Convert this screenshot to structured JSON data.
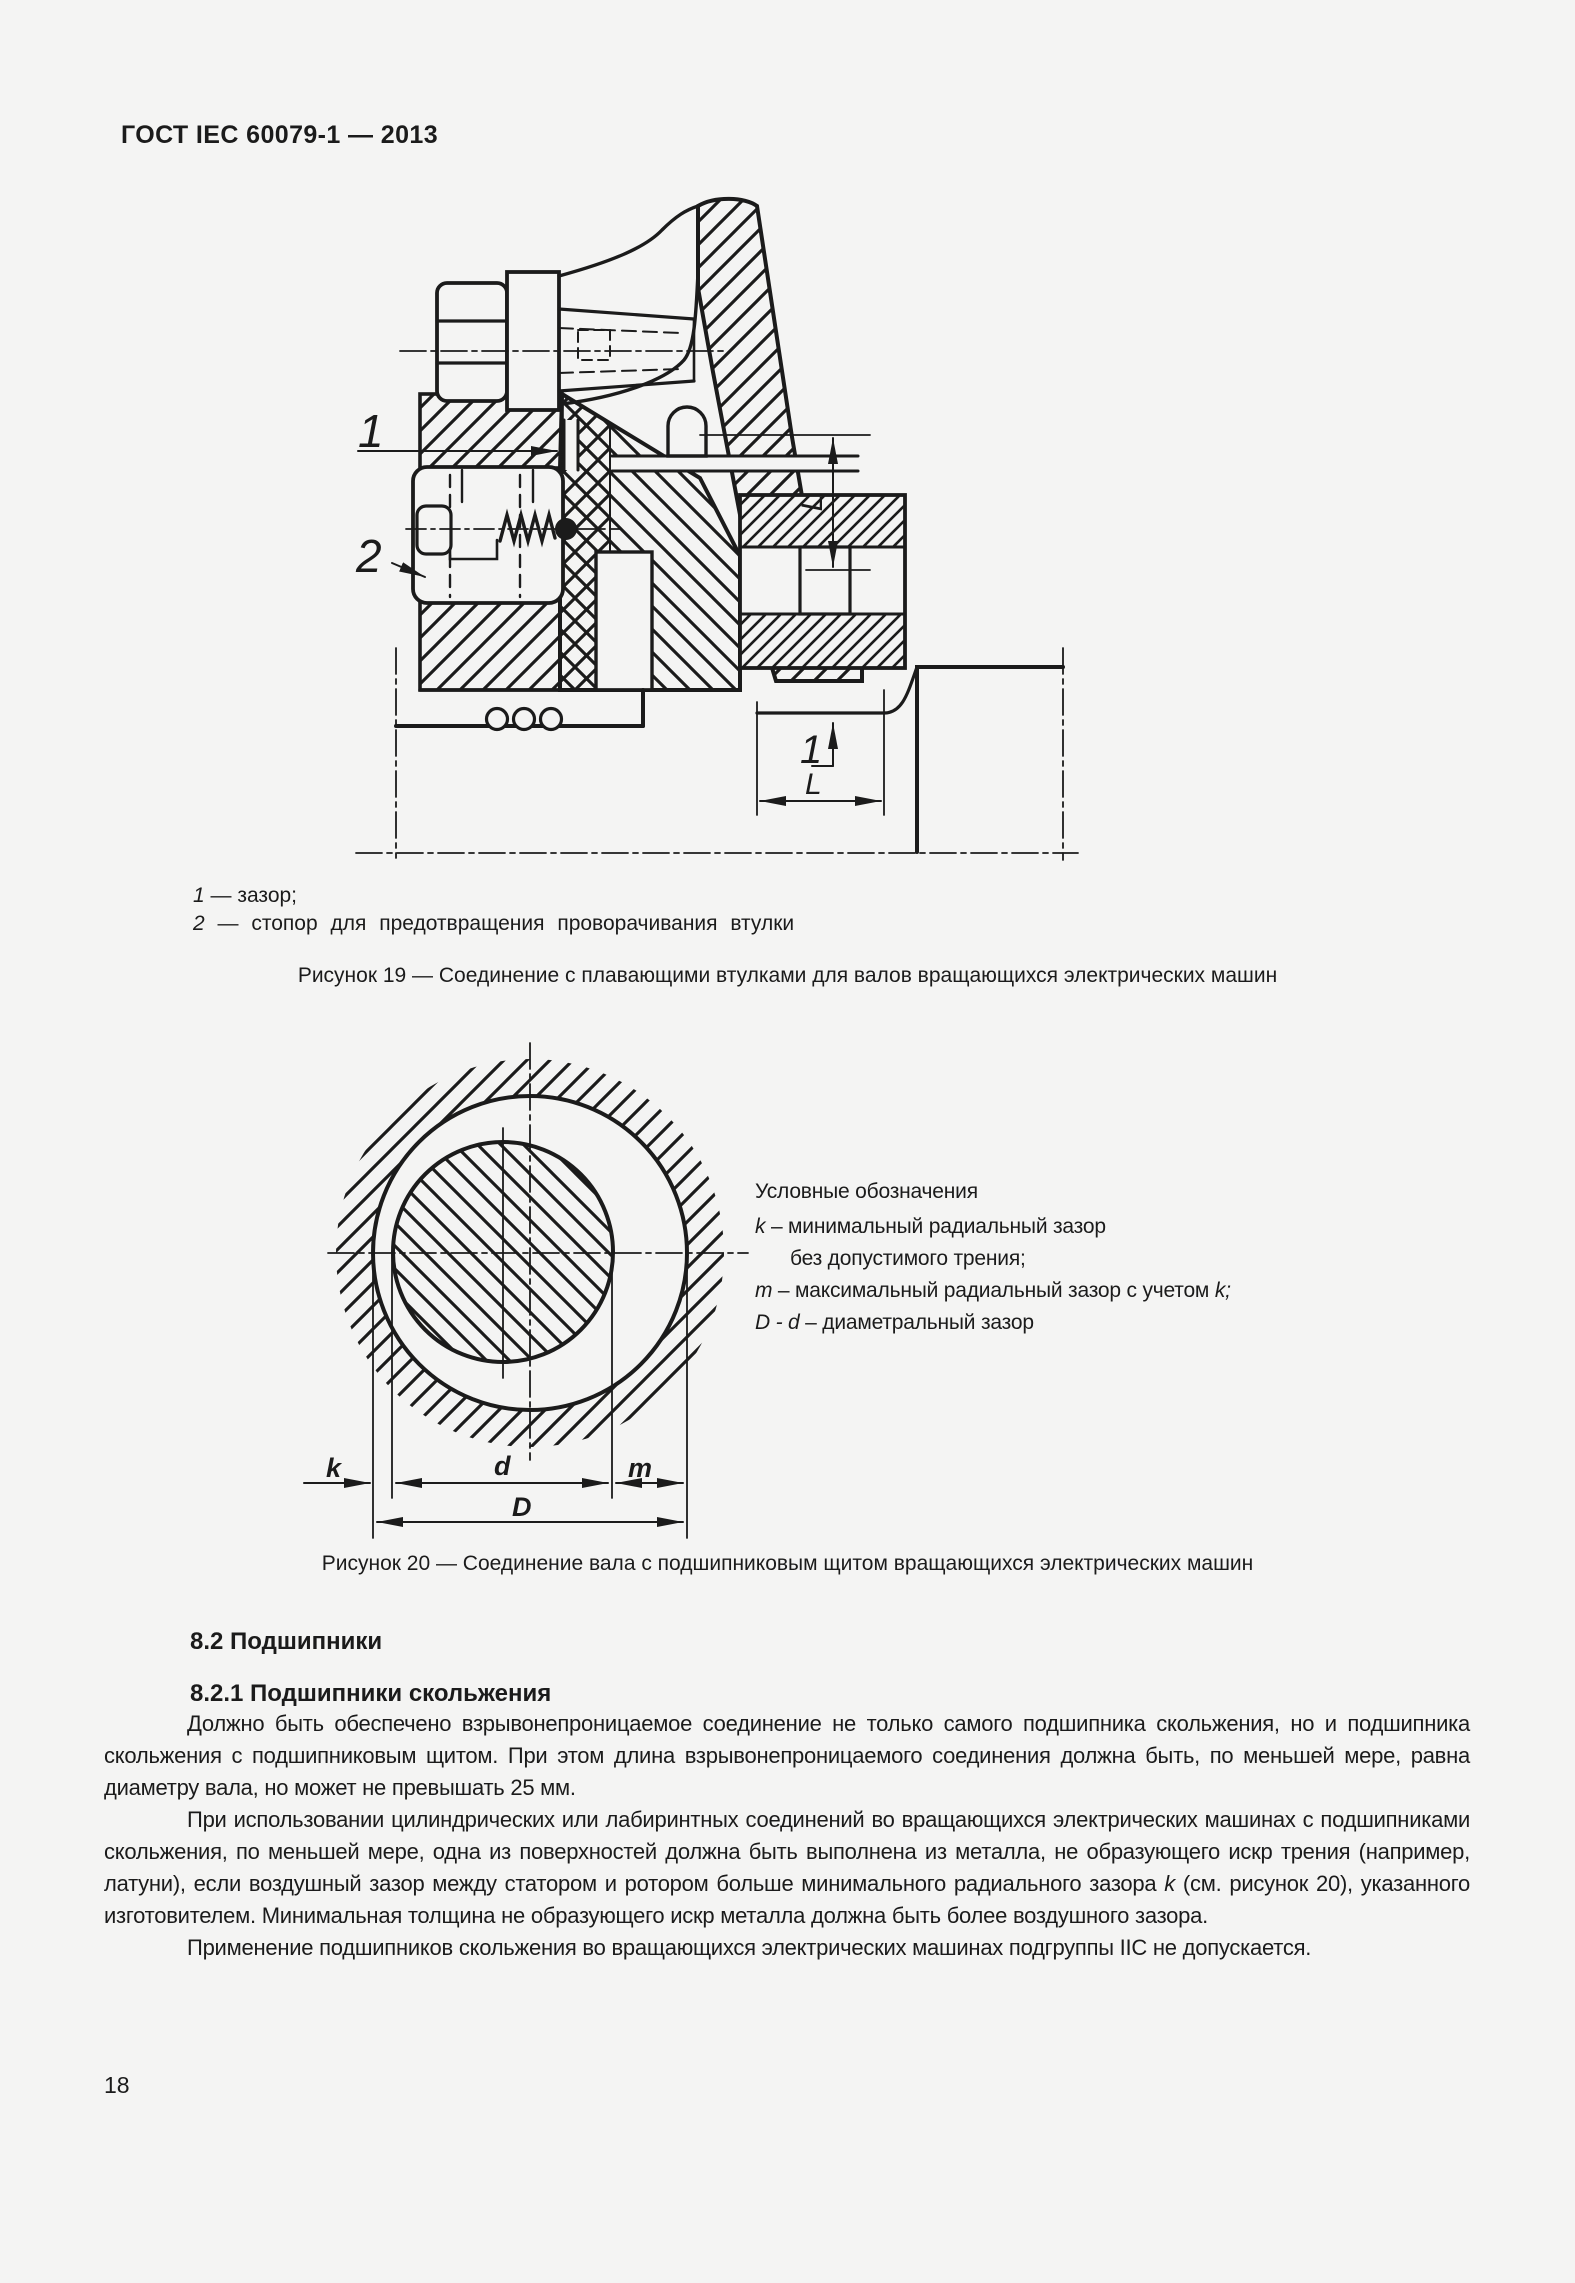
{
  "header": {
    "title": "ГОСТ IEC 60079-1 — 2013"
  },
  "figure19": {
    "labels": {
      "pointer1": "1",
      "pointer2": "2",
      "dim_l_vertical": "L",
      "dim_l_bottom": "L",
      "pointer1_bottom": "1"
    },
    "legend": {
      "item1_num": "1",
      "item1_text": " — зазор;",
      "item2_num": "2",
      "item2_text": " — стопор для предотвращения проворачивания втулки"
    },
    "caption": "Рисунок 19 — Соединение с плавающими втулками для валов вращающихся электрических машин"
  },
  "figure20": {
    "labels": {
      "k": "k",
      "d": "d",
      "m": "m",
      "D": "D"
    },
    "legend": {
      "title": "Условные обозначения",
      "k_sym": "k",
      "k_text": " – минимальный радиальный зазор",
      "k_text2": "без допустимого трения;",
      "m_sym": "m",
      "m_text": " – максимальный  радиальный зазор с учетом ",
      "m_k": "k;",
      "dd_sym": "D - d",
      "dd_text": " – диаметральный зазор"
    },
    "caption": "Рисунок 20 — Соединение вала с подшипниковым щитом вращающихся электрических машин"
  },
  "sections": {
    "h82": "8.2 Подшипники",
    "h821": "8.2.1 Подшипники скольжения"
  },
  "body": {
    "p1": "Должно быть обеспечено взрывонепроницаемое соединение не только самого подшипника скольжения, но и подшипника скольжения с подшипниковым щитом. При этом длина взрывонепроницаемого соединения должна быть, по меньшей мере, равна диаметру вала, но может не превышать 25 мм.",
    "p2a": "При использовании цилиндрических или лабиринтных соединений во вращающихся электрических машинах с подшипниками скольжения, по меньшей мере, одна из поверхностей должна быть выполнена из металла, не образующего искр трения (например, латуни), если воздушный зазор между статором и ротором больше минимального радиального зазора ",
    "p2k": "k",
    "p2b": " (см. рисунок 20), указанного изготовителем. Минимальная толщина не образующего искр металла должна быть более воздушного зазора.",
    "p3": "Применение подшипников скольжения во вращающихся электрических машинах подгруппы IIC не допускается."
  },
  "footer": {
    "page_number": "18"
  }
}
